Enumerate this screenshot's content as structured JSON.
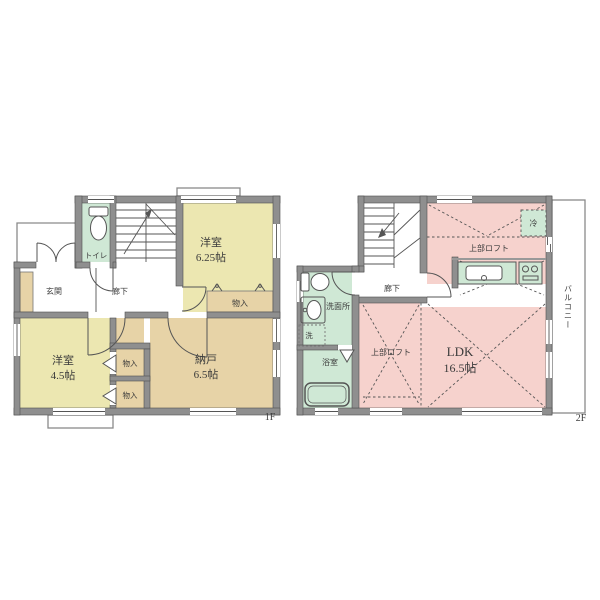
{
  "colors": {
    "wall": "#8f8f8f",
    "wall_edge": "#4f4f4f",
    "yellow": "#ece7b1",
    "tan": "#e7d3a7",
    "green": "#cfe8d5",
    "pink": "#f6d2cd",
    "line": "#555555"
  },
  "floor1": {
    "label": "1F",
    "rooms": {
      "toilet": "トイレ",
      "west_room_625": "洋室",
      "west_room_625_size": "6.25帖",
      "entrance": "玄関",
      "hallway": "廊下",
      "west_room_45": "洋室",
      "west_room_45_size": "4.5帖",
      "storage_room": "納戸",
      "storage_room_size": "6.5帖",
      "closet_top": "物入",
      "closet_a": "物入",
      "closet_b": "物入"
    }
  },
  "floor2": {
    "label": "2F",
    "rooms": {
      "hallway": "廊下",
      "washroom": "洗面所",
      "washer": "洗",
      "bathroom": "浴室",
      "ldk": "LDK",
      "ldk_size": "16.5帖",
      "loft_top": "上部ロフト",
      "loft_left": "上部ロフト",
      "fridge": "冷",
      "balcony": "バルコニー"
    }
  }
}
